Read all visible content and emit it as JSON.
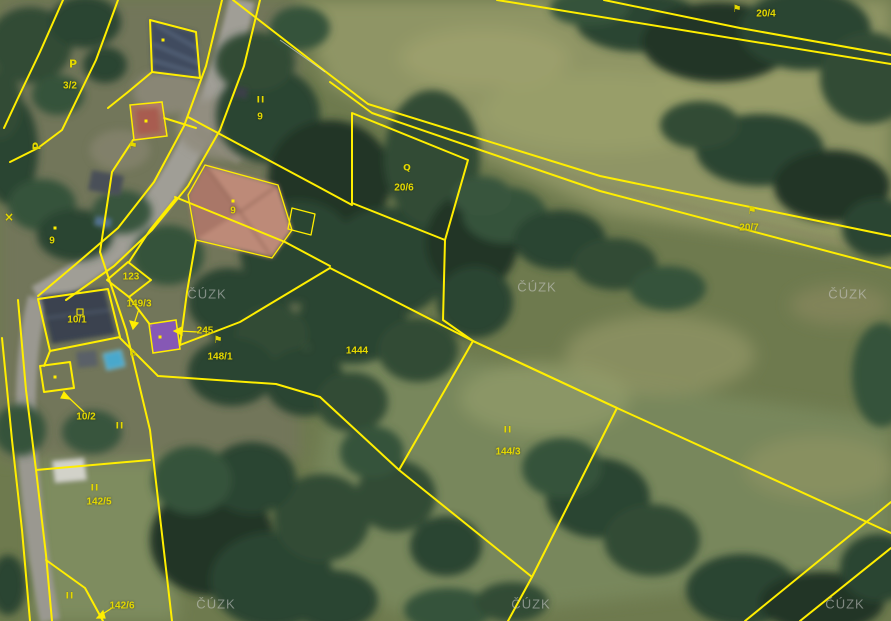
{
  "map": {
    "watermark_text": "ČÚZK",
    "watermarks": [
      {
        "x": 207,
        "y": 294
      },
      {
        "x": 537,
        "y": 287
      },
      {
        "x": 848,
        "y": 294
      },
      {
        "x": 216,
        "y": 604
      },
      {
        "x": 531,
        "y": 604
      },
      {
        "x": 845,
        "y": 604
      }
    ],
    "colors": {
      "boundary": "#ffee00",
      "label": "#e4d800",
      "selected-parcel": "#8b51cc",
      "highlight-parcel": "#d4705f",
      "watermark-col": "#cdcdcd"
    },
    "parcel_labels": [
      {
        "text": "3/2",
        "x": 70,
        "y": 86
      },
      {
        "text": "9",
        "x": 260,
        "y": 117
      },
      {
        "text": "9",
        "x": 233,
        "y": 211
      },
      {
        "text": "9",
        "x": 52,
        "y": 241
      },
      {
        "text": "20/4",
        "x": 766,
        "y": 14
      },
      {
        "text": "20/6",
        "x": 404,
        "y": 188
      },
      {
        "text": "20/7",
        "x": 749,
        "y": 228
      },
      {
        "text": "1444",
        "x": 357,
        "y": 351
      },
      {
        "text": "144/3",
        "x": 508,
        "y": 452
      },
      {
        "text": "142/5",
        "x": 99,
        "y": 502
      },
      {
        "text": "142/6",
        "x": 122,
        "y": 606
      },
      {
        "text": "149/3",
        "x": 139,
        "y": 304
      },
      {
        "text": "245",
        "x": 205,
        "y": 331
      },
      {
        "text": "123",
        "x": 131,
        "y": 277
      },
      {
        "text": "10/1",
        "x": 77,
        "y": 320
      },
      {
        "text": "10/2",
        "x": 86,
        "y": 417
      },
      {
        "text": "148/1",
        "x": 220,
        "y": 357
      }
    ],
    "symbols": [
      {
        "type": "meadow",
        "glyph": "II",
        "x": 261,
        "y": 101,
        "rot": 0
      },
      {
        "type": "meadow",
        "glyph": "II",
        "x": 508,
        "y": 431,
        "rot": 0
      },
      {
        "type": "meadow",
        "glyph": "II",
        "x": 95,
        "y": 489,
        "rot": 0
      },
      {
        "type": "meadow",
        "glyph": "II",
        "x": 70,
        "y": 597,
        "rot": 0
      },
      {
        "type": "meadow",
        "glyph": "II",
        "x": 120,
        "y": 427,
        "rot": 0
      },
      {
        "type": "orchard",
        "glyph": "P",
        "x": 73,
        "y": 64,
        "rot": 0
      },
      {
        "type": "orchard",
        "glyph": "P",
        "x": 37,
        "y": 146,
        "rot": -90
      },
      {
        "type": "forest",
        "glyph": "⚑",
        "x": 737,
        "y": 10,
        "rot": 0
      },
      {
        "type": "forest",
        "glyph": "⚑",
        "x": 752,
        "y": 212,
        "rot": 0
      },
      {
        "type": "forest",
        "glyph": "⚑",
        "x": 218,
        "y": 341,
        "rot": 0
      },
      {
        "type": "forest",
        "glyph": "⚑",
        "x": 133,
        "y": 147,
        "rot": 0
      },
      {
        "type": "scrub",
        "glyph": "Q",
        "x": 407,
        "y": 169,
        "rot": 0
      },
      {
        "type": "house",
        "glyph": "⌂",
        "x": 133,
        "y": 352,
        "rot": 0
      },
      {
        "type": "building-mark",
        "glyph": "",
        "x": 80,
        "y": 312,
        "rot": 0
      },
      {
        "type": "cross",
        "glyph": "×",
        "x": 9,
        "y": 217,
        "rot": 0
      }
    ],
    "dots": [
      {
        "x": 160,
        "y": 337
      },
      {
        "x": 146,
        "y": 121
      },
      {
        "x": 233,
        "y": 201
      },
      {
        "x": 55,
        "y": 228
      },
      {
        "x": 55,
        "y": 377
      },
      {
        "x": 163,
        "y": 40
      }
    ]
  }
}
